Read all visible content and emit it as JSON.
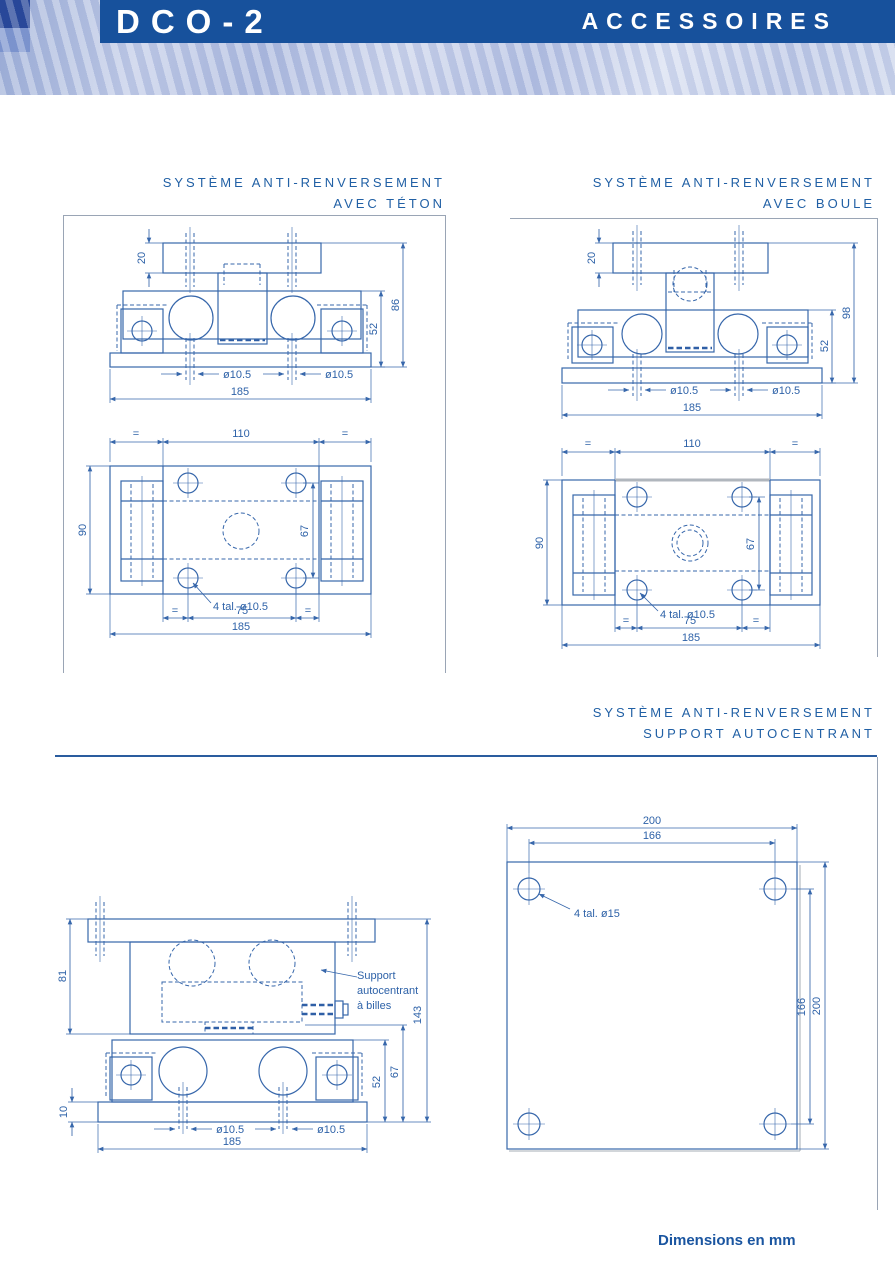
{
  "header": {
    "product": "DCO-2",
    "page_title": "ACCESSOIRES"
  },
  "sections": {
    "teton": {
      "line1": "SYSTÈME ANTI-RENVERSEMENT",
      "line2": "AVEC TÉTON"
    },
    "boule": {
      "line1": "SYSTÈME ANTI-RENVERSEMENT",
      "line2": "AVEC BOULE"
    },
    "autocentrant": {
      "line1": "SYSTÈME ANTI-RENVERSEMENT",
      "line2": "SUPPORT AUTOCENTRANT"
    }
  },
  "drawings": {
    "teton_front": {
      "height_top_bar": "20",
      "height_total": "86",
      "height_body": "52",
      "hole_dia": "ø10.5",
      "width_total": "185"
    },
    "teton_top": {
      "equal": "=",
      "width_center": "110",
      "depth_total": "90",
      "hole_spacing_y": "67",
      "holes_note": "4 tal. ø10.5",
      "hole_spacing_x": "75",
      "width_total": "185"
    },
    "boule_front": {
      "height_top_bar": "20",
      "height_total": "98",
      "height_body": "52",
      "hole_dia": "ø10.5",
      "width_total": "185"
    },
    "boule_top": {
      "equal": "=",
      "width_center": "110",
      "depth_total": "90",
      "hole_spacing_y": "67",
      "holes_note": "4 tal. ø10.5",
      "hole_spacing_x": "75",
      "width_total": "185"
    },
    "auto_side": {
      "height_top": "81",
      "height_total": "143",
      "height_mid": "67",
      "height_body": "52",
      "height_base": "10",
      "hole_dia": "ø10.5",
      "width_total": "185",
      "label_line1": "Support",
      "label_line2": "autocentrant",
      "label_line3": "à billes"
    },
    "plate_top": {
      "width_outer": "200",
      "width_holes": "166",
      "holes_note": "4 tal. ø15"
    }
  },
  "footer": {
    "note": "Dimensions en mm"
  },
  "colors": {
    "banner": "#17519c",
    "line": "#3767ab",
    "title_text": "#2160a5"
  }
}
